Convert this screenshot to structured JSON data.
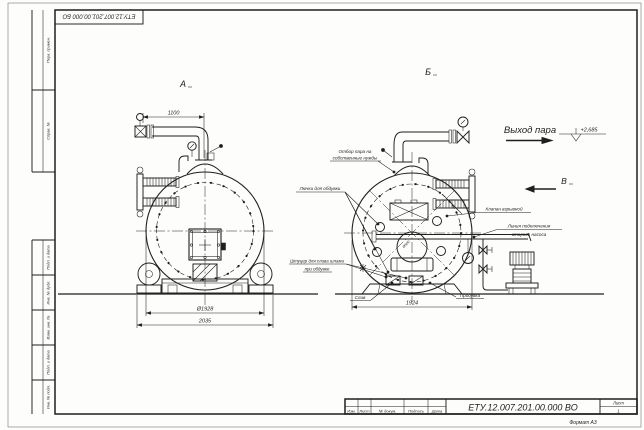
{
  "drawing": {
    "code_stamp_rotated": "ЕТУ.12.007.201.00.000  БО",
    "code_main": "ЕТУ.12.007.201.00.000  ВО",
    "format_label": "Формат А3",
    "ink_color": "#1f1f1f",
    "paper_color": "#fdfdfb"
  },
  "frame_margin_cells": {
    "perv": "Перв. примен.",
    "sprav": "Справ. №",
    "podp1": "Подп. и дата",
    "inv_dubl": "Инв. № дубл.",
    "vzam": "Взам. инв. №",
    "podp2": "Подп. и дата",
    "inv_podl": "Инв. № подл."
  },
  "title_block": {
    "col_izm": "Изм.",
    "col_list": "Лист",
    "col_dokum": "№ докум.",
    "col_podp": "Подпись",
    "col_data": "Дата",
    "list_label": "Лист",
    "list_value": "1"
  },
  "views": {
    "a": "А",
    "b": "Б",
    "v": "В"
  },
  "labels": {
    "steam_out": "Выход пара",
    "elevation": "+2,685",
    "own_needs_line1": "Отбор пара на",
    "own_needs_line2": "собственные нужды",
    "blow_hatches": "Лючки для обдувки",
    "explosion_valve": "Клапан взрывной",
    "pump_line1": "Линия подключения",
    "pump_line2": "второго насоса",
    "sludge_line1": "Штуцер для слива шлама",
    "sludge_line2": "при обдувке",
    "drain": "Слив",
    "blowdown": "Продувка",
    "manhole_dia": "Ø500"
  },
  "dimensions": {
    "pipe_span": "1100",
    "shell_dia": "Ø1928",
    "base_width": "2035",
    "rear_width": "1924"
  }
}
